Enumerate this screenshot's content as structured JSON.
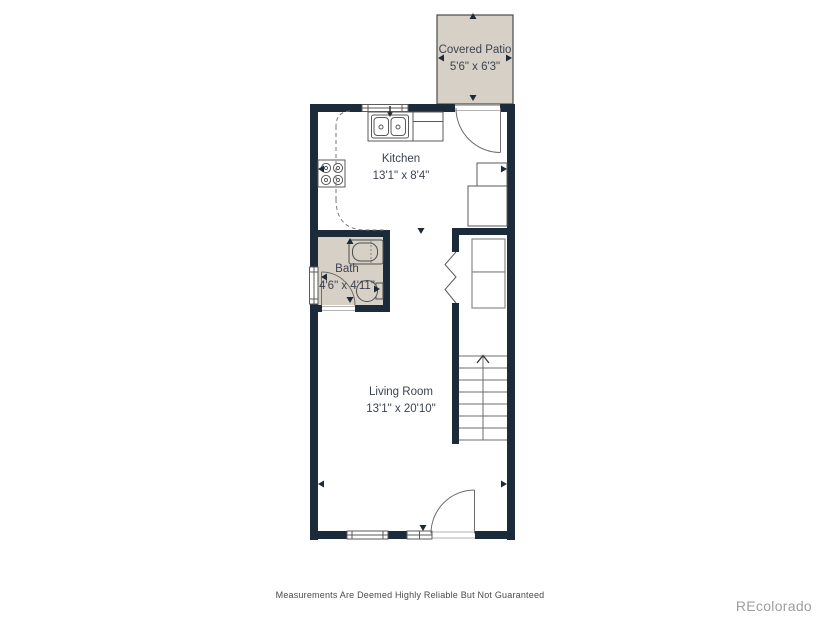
{
  "colors": {
    "wall": "#1c2b3a",
    "room_fill": "#d7d0c6",
    "fixture_line": "#5a5a5a",
    "label_text": "#3c4350",
    "disclaimer_text": "#4a4a4a",
    "watermark_text": "#9d9d9d"
  },
  "rooms": {
    "covered_patio": {
      "name": "Covered Patio",
      "dimensions": "5'6\" x 6'3\""
    },
    "kitchen": {
      "name": "Kitchen",
      "dimensions": "13'1\" x 8'4\""
    },
    "bath": {
      "name": "Bath",
      "dimensions": "4'6\" x 4'11\""
    },
    "living_room": {
      "name": "Living Room",
      "dimensions": "13'1\" x 20'10\""
    }
  },
  "fixtures": {
    "kitchen": [
      "double-sink",
      "stove",
      "refrigerator",
      "counter",
      "upper-cabinets-dashed"
    ],
    "bath": [
      "bathtub",
      "toilet",
      "window"
    ],
    "laundry_closet": [
      "stacked-washer-dryer",
      "bifold-doors"
    ],
    "stairs": {
      "direction": "up",
      "tread_lines": 8
    }
  },
  "footer": {
    "disclaimer": "Measurements Are Deemed Highly Reliable But Not Guaranteed"
  },
  "watermark": "REcolorado"
}
